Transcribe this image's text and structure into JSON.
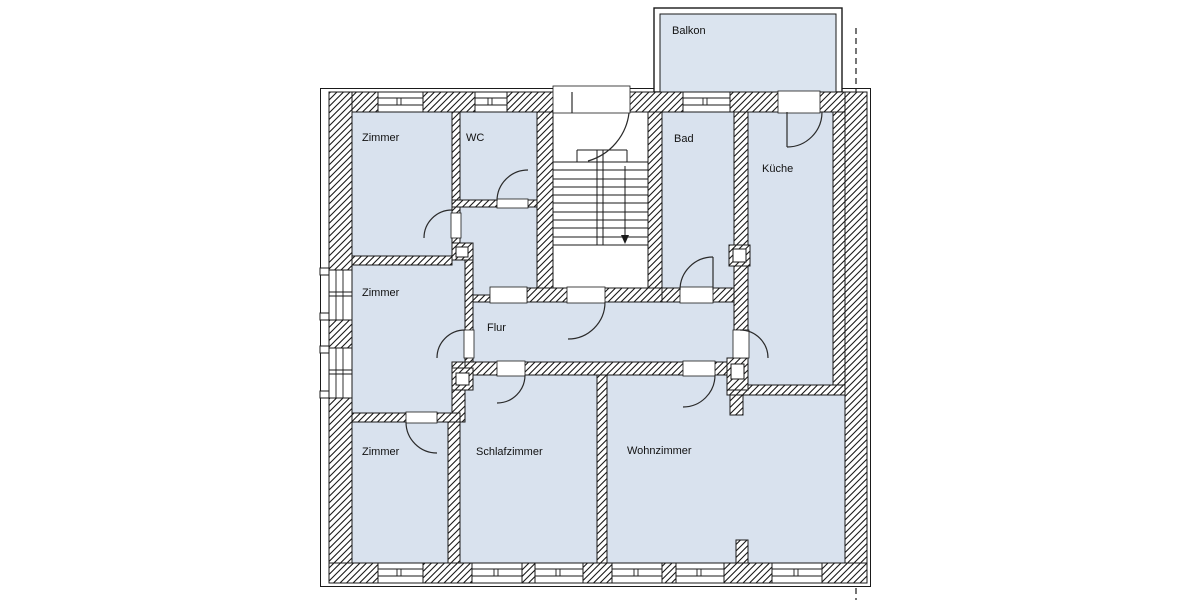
{
  "page": {
    "background": "#ffffff"
  },
  "colors": {
    "room_fill": "#d9e2ee",
    "balcony_fill": "#dbe4ef",
    "line": "#1a1a1a",
    "wall_fill": "#ffffff"
  },
  "rooms": [
    {
      "id": "zimmer-top-left",
      "label": "Zimmer"
    },
    {
      "id": "wc",
      "label": "WC"
    },
    {
      "id": "bad",
      "label": "Bad"
    },
    {
      "id": "kueche",
      "label": "Küche"
    },
    {
      "id": "zimmer-middle-left",
      "label": "Zimmer"
    },
    {
      "id": "flur",
      "label": "Flur"
    },
    {
      "id": "zimmer-bottom-left",
      "label": "Zimmer"
    },
    {
      "id": "schlafzimmer",
      "label": "Schlafzimmer"
    },
    {
      "id": "wohnzimmer",
      "label": "Wohnzimmer"
    },
    {
      "id": "balkon",
      "label": "Balkon"
    }
  ],
  "staircase": {
    "tread_count": 11,
    "flights": 2,
    "direction_arrow": "down"
  }
}
